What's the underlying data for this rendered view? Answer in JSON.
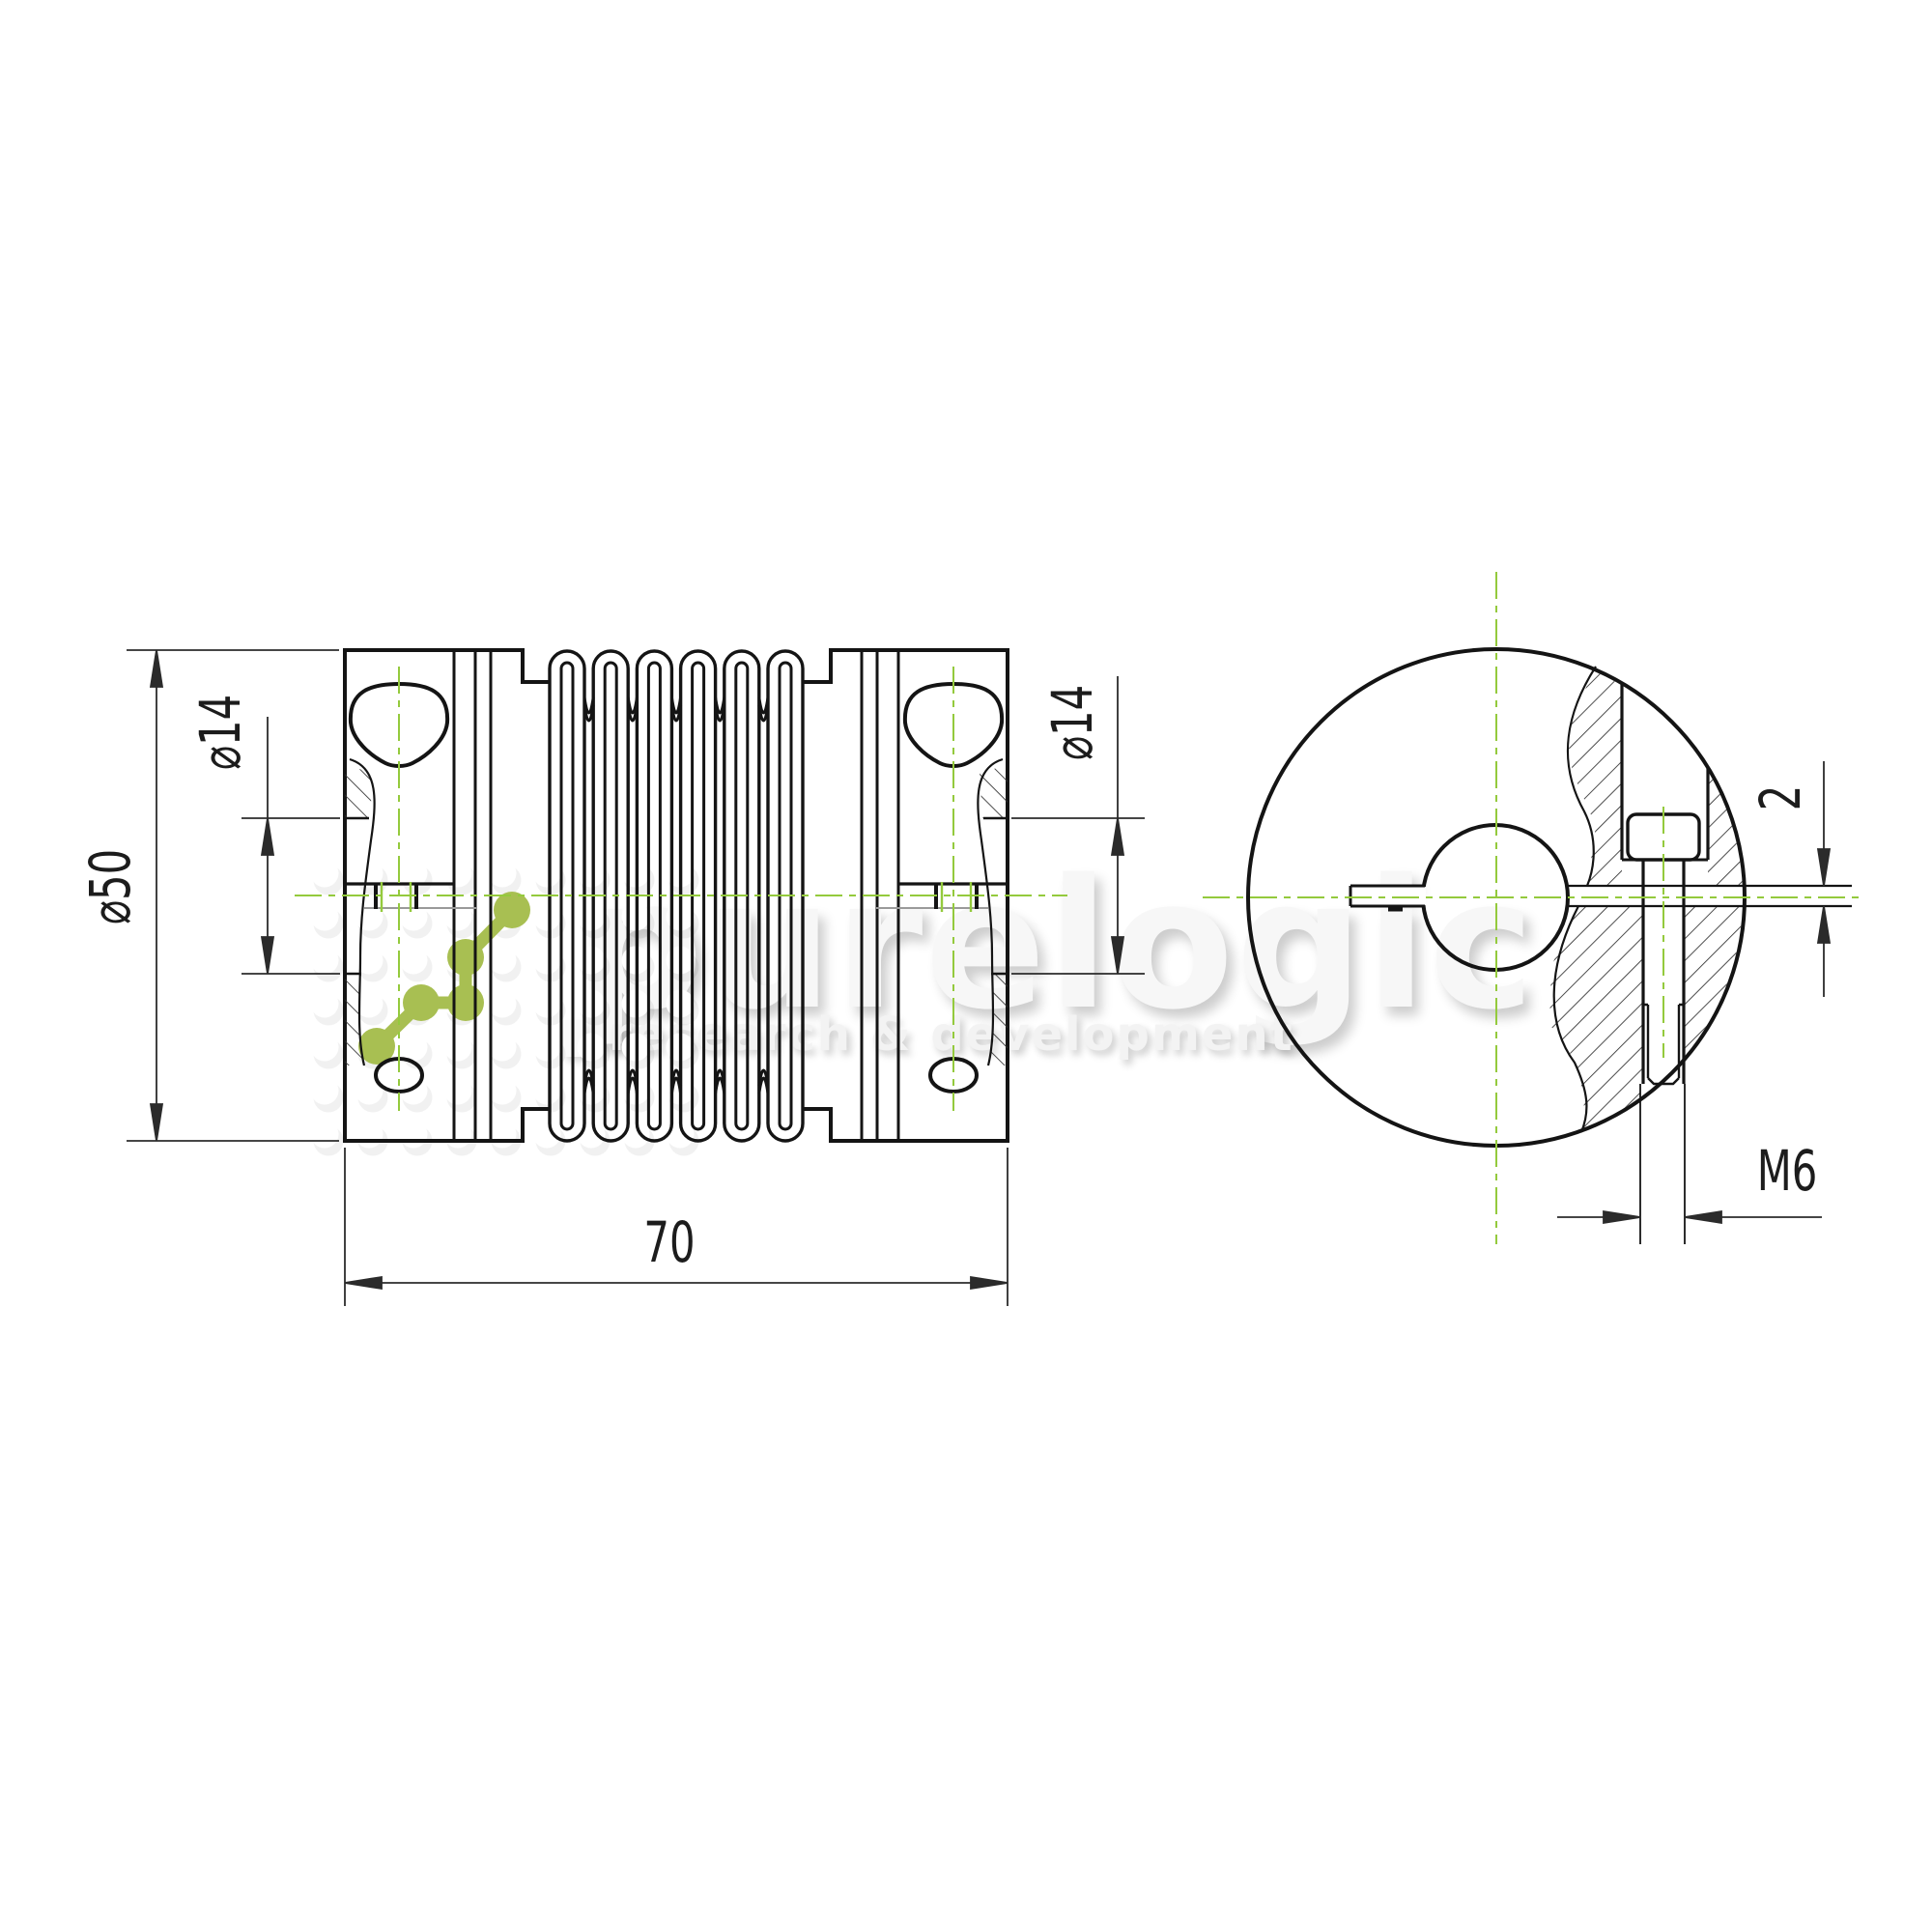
{
  "drawing": {
    "dimensions": {
      "outer_diameter": "⌀50",
      "bore_left": "⌀14",
      "bore_right": "⌀14",
      "overall_length": "70",
      "slit_width": "2",
      "clamp_screw": "M6"
    },
    "watermark": {
      "brand": "purelogic",
      "tagline": "research & development"
    },
    "colors": {
      "line": "#141414",
      "dim_line": "#2b2b2b",
      "centerline": "#94ca3d",
      "logo_green": "#a8bf52",
      "watermark_gray": "#f7f7f7"
    }
  }
}
